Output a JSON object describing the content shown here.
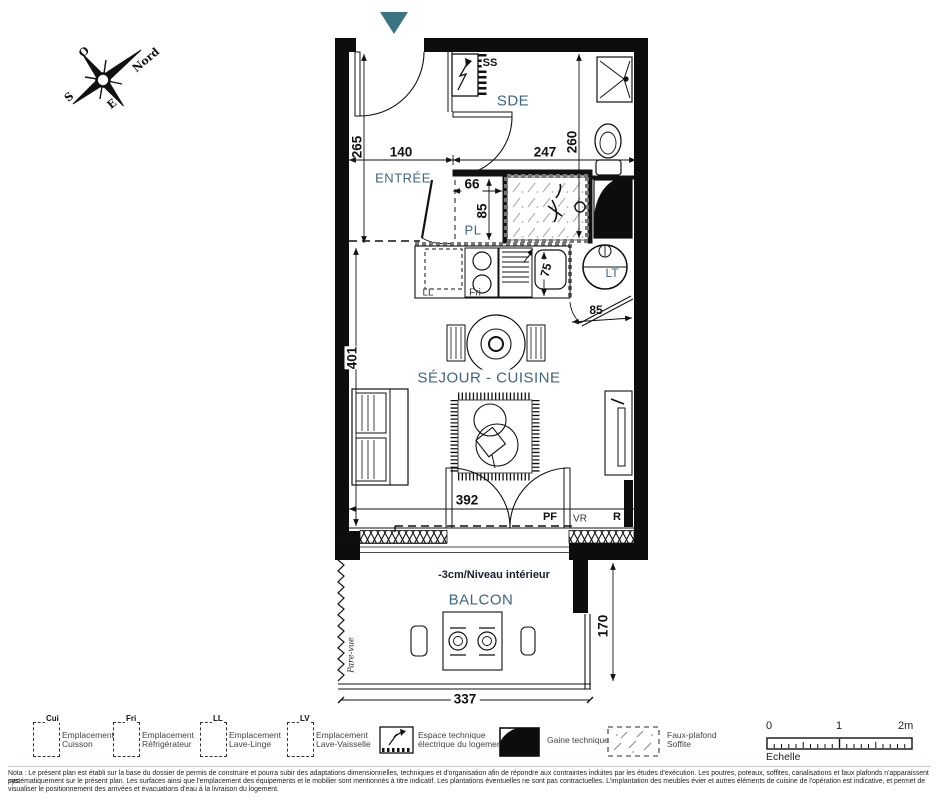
{
  "colors": {
    "accent": "#3a7480",
    "room_label": "#3f6582",
    "ink": "#1a1a1a"
  },
  "compass": {
    "north": "Nord",
    "west": "O",
    "south": "S",
    "east": "E"
  },
  "rooms": {
    "sde": "SDE",
    "entree": "ENTRÉE",
    "pl": "PL",
    "sejour_cuisine": "SÉJOUR - CUISINE",
    "balcon": "BALCON"
  },
  "annotations": {
    "ss": "SS",
    "ll": "LL",
    "fri": "Fri",
    "lt": "LT",
    "pf": "PF",
    "vr": "VR",
    "r": "R",
    "pare_vue": "Pare-vue",
    "niveau": "-3cm/Niveau intérieur"
  },
  "dimensions": {
    "entree_height": "265",
    "entree_width": "140",
    "sde_width": "247",
    "sde_height": "260",
    "pl_width": "66",
    "pl_depth": "85",
    "sejour_height": "401",
    "sink": "75",
    "door": "85",
    "sejour_width": "392",
    "balcon_height": "170",
    "balcon_width": "337"
  },
  "legend": {
    "items": [
      {
        "tag": "Cui",
        "line1": "Emplacement",
        "line2": "Cuisson"
      },
      {
        "tag": "Fri",
        "line1": "Emplacement",
        "line2": "Réfrigérateur"
      },
      {
        "tag": "LL",
        "line1": "Emplacement",
        "line2": "Lave-Linge"
      },
      {
        "tag": "LV",
        "line1": "Emplacement",
        "line2": "Lave-Vaisselle"
      },
      {
        "tag": "",
        "line1": "Espace technique",
        "line2": "électrique du logement"
      },
      {
        "tag": "",
        "line1": "Gaine technique",
        "line2": ""
      },
      {
        "tag": "",
        "line1": "Faux-plafond",
        "line2": "Soffite"
      }
    ]
  },
  "scale": {
    "t0": "0",
    "t1": "1",
    "t2": "2m",
    "caption": "Echelle"
  },
  "nota": {
    "line1": "Nota : Le présent plan est établi sur la base du dossier de permis de construire et pourra subir des adaptations dimensionnelles, techniques et d'organisation afin de répondre aux contraintes induites par les études d'exécution. Les poutres, poteaux, soffites, canalisations et faux plafonds n'apparaissent pas",
    "line2": "systématiquement sur le présent plan. Les surfaces ainsi que l'emplacement des équipements et le mobilier sont mentionnés à titre indicatif. Les plantations éventuelles ne sont pas contractuelles. L'implantation des meubles évier et autres éléments de cuisine de l'opération est indicative, et permet de",
    "line3": "visualiser le positionnement des arrivées et évacuations d'eau à la livraison du logement."
  }
}
